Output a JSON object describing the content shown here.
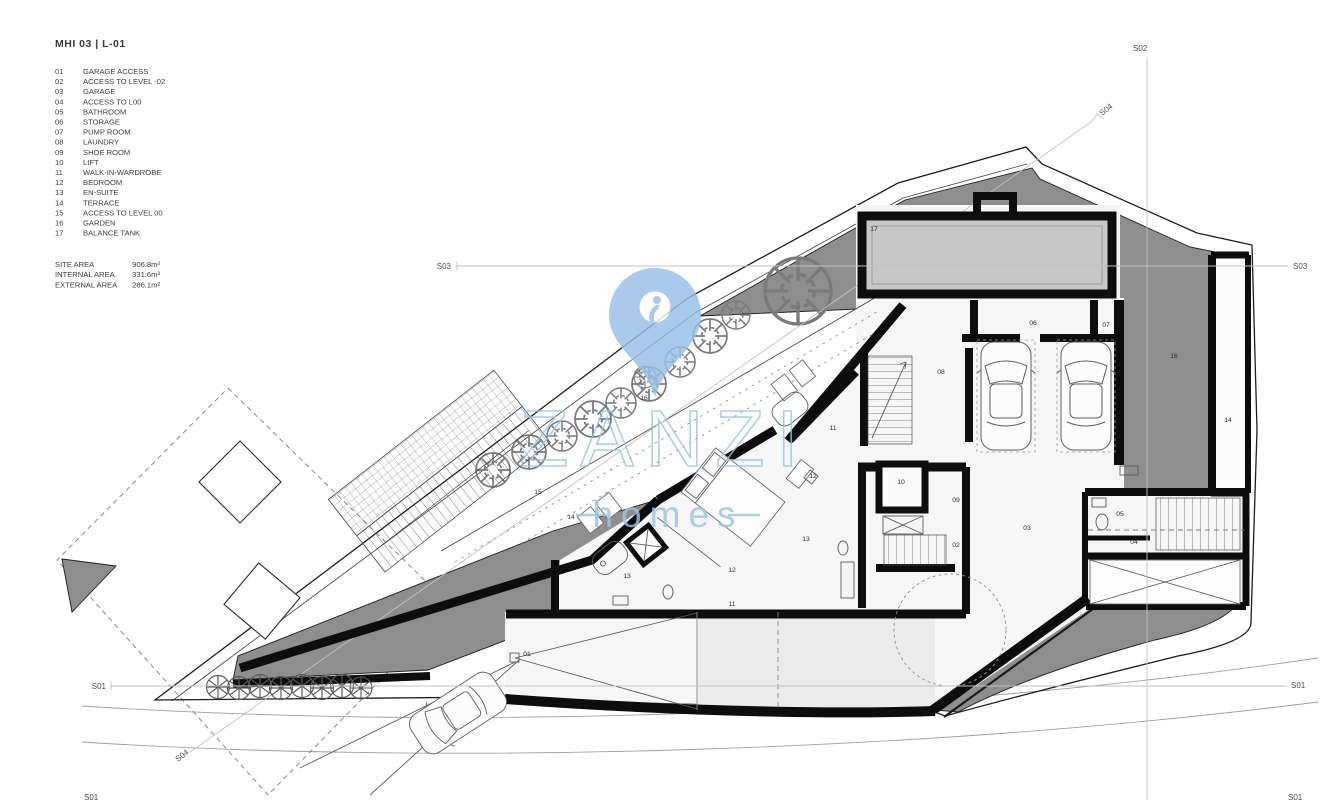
{
  "header": {
    "title": "MHI 03  |  L-01"
  },
  "legend": [
    {
      "num": "01",
      "label": "GARAGE ACCESS"
    },
    {
      "num": "02",
      "label": "ACCESS TO LEVEL -02"
    },
    {
      "num": "03",
      "label": "GARAGE"
    },
    {
      "num": "04",
      "label": "ACCESS TO L00"
    },
    {
      "num": "05",
      "label": "BATHROOM"
    },
    {
      "num": "06",
      "label": "STORAGE"
    },
    {
      "num": "07",
      "label": "PUMP ROOM"
    },
    {
      "num": "08",
      "label": "LAUNDRY"
    },
    {
      "num": "09",
      "label": "SHOE ROOM"
    },
    {
      "num": "10",
      "label": "LIFT"
    },
    {
      "num": "11",
      "label": "WALK-IN-WARDROBE"
    },
    {
      "num": "12",
      "label": "BEDROOM"
    },
    {
      "num": "13",
      "label": "EN-SUITE"
    },
    {
      "num": "14",
      "label": "TERRACE"
    },
    {
      "num": "15",
      "label": "ACCESS TO LEVEL 00"
    },
    {
      "num": "16",
      "label": "GARDEN"
    },
    {
      "num": "17",
      "label": "BALANCE TANK"
    }
  ],
  "areas": [
    {
      "label": "SITE AREA",
      "value": "906.8m²"
    },
    {
      "label": "INTERNAL AREA",
      "value": "331.6m²"
    },
    {
      "label": "EXTERNAL AREA",
      "value": "286.1m²"
    }
  ],
  "watermark": {
    "brand": "ZANZI",
    "sub": "homes",
    "color": "#9CC3E9"
  },
  "sections": {
    "s01": "S01",
    "s02": "S02",
    "s03": "S03",
    "s04": "S04"
  },
  "plan": {
    "labels": [
      {
        "t": "17",
        "x": 874,
        "y": 231
      },
      {
        "t": "06",
        "x": 1033,
        "y": 325
      },
      {
        "t": "07",
        "x": 1106,
        "y": 327
      },
      {
        "t": "08",
        "x": 941,
        "y": 374
      },
      {
        "t": "16",
        "x": 1174,
        "y": 358
      },
      {
        "t": "16",
        "x": 644,
        "y": 400
      },
      {
        "t": "10",
        "x": 901,
        "y": 484
      },
      {
        "t": "09",
        "x": 956,
        "y": 502
      },
      {
        "t": "02",
        "x": 956,
        "y": 547
      },
      {
        "t": "03",
        "x": 1027,
        "y": 530
      },
      {
        "t": "05",
        "x": 1120,
        "y": 516
      },
      {
        "t": "04",
        "x": 1134,
        "y": 544
      },
      {
        "t": "11",
        "x": 833,
        "y": 430
      },
      {
        "t": "12",
        "x": 813,
        "y": 478
      },
      {
        "t": "12",
        "x": 732,
        "y": 572
      },
      {
        "t": "13",
        "x": 806,
        "y": 541
      },
      {
        "t": "13",
        "x": 627,
        "y": 578
      },
      {
        "t": "11",
        "x": 732,
        "y": 606
      },
      {
        "t": "14",
        "x": 571,
        "y": 519
      },
      {
        "t": "15",
        "x": 538,
        "y": 494
      },
      {
        "t": "14",
        "x": 1228,
        "y": 422
      },
      {
        "t": "01",
        "x": 527,
        "y": 656
      }
    ]
  },
  "colors": {
    "garden_gray": "#8e8e8e",
    "tank_gray": "#c8c8c8",
    "floor": "#f6f6f6",
    "wall": "#0d0d0d",
    "watermark_blue": "#9CC3E9"
  }
}
